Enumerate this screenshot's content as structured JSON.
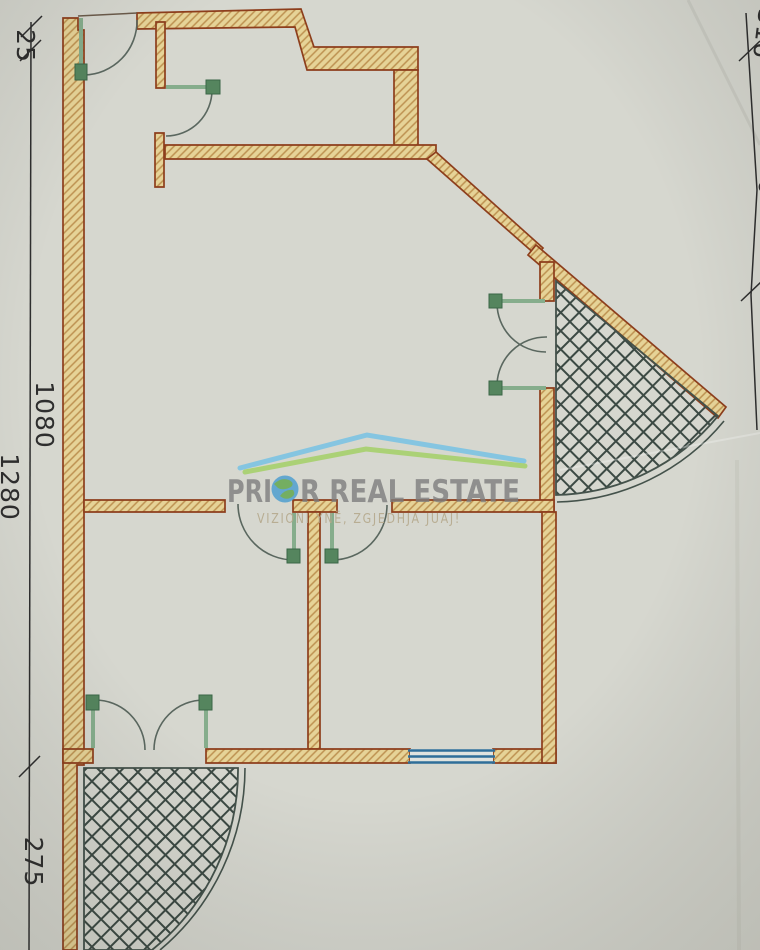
{
  "page": {
    "kind": "scanned apartment floor plan"
  },
  "watermark": {
    "title": "PRIOR REAL ESTATE",
    "title_part1": "PRI",
    "title_part2": "R REAL ESTATE",
    "subtitle": "VIZIONI YNË, ZGJEDHJA JUAJ!",
    "colors": {
      "roof_blue": "#7cc3e2",
      "roof_green": "#a6d06c",
      "title_grey": "#7d7d7d",
      "subtitle_tan": "#b5a98c",
      "globe_blue": "#4f9fd0",
      "globe_green": "#63a84e"
    }
  },
  "dimension_labels": {
    "left_top": "25",
    "left_main": "1080",
    "left_bottom": "275",
    "left_edge_partial": "1280",
    "right_top_partial": "316",
    "right_mid_partial": "310"
  },
  "drawing": {
    "colors": {
      "paper": "#d6d7cf",
      "wall_fill": "#e6d397",
      "wall_hatch": "#bd9150",
      "wall_outline": "#8d3e1c",
      "door_green": "#86ad8c",
      "door_block_green": "#55855e",
      "swing_arc": "#5a675f",
      "balcony_crosshatch": "#3c4a44",
      "window_blue": "#2f6e99",
      "dimension_ink": "#2e2e2e"
    }
  }
}
